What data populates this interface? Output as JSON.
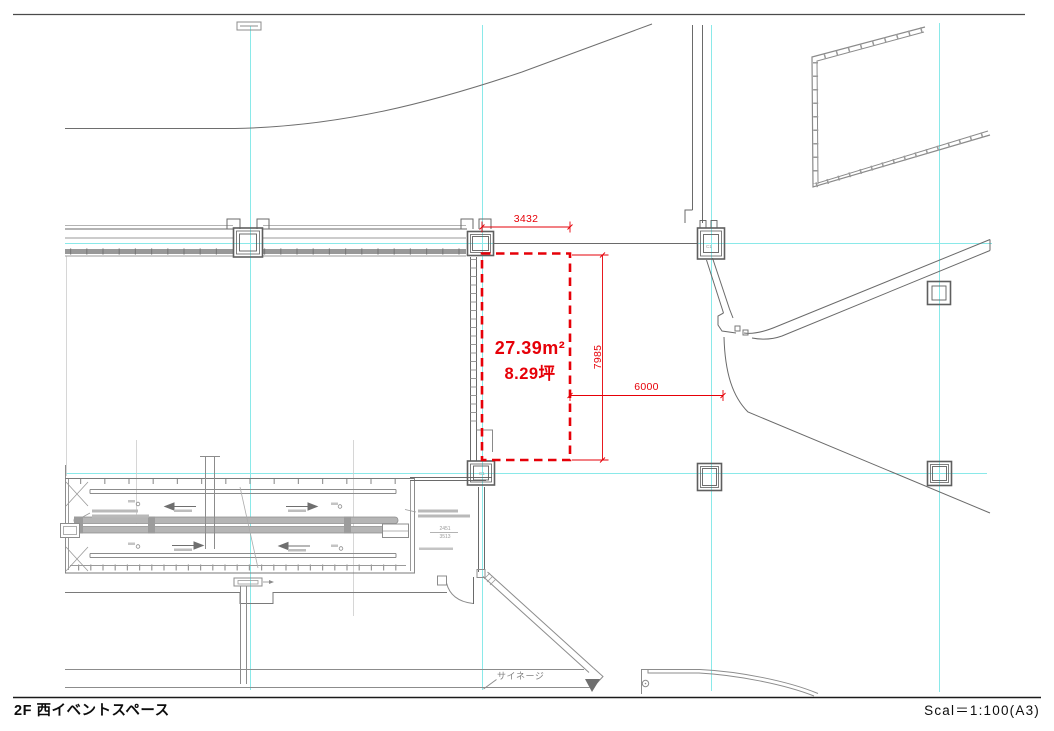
{
  "drawing": {
    "sheet": {
      "title": "2F 西イベントスペース",
      "scale_label": "Scal＝1:100(A3)"
    },
    "highlight_zone": {
      "area_m2": "27.39m²",
      "area_tsubo": "8.29坪",
      "dim_width_mm": "3432",
      "dim_height_mm": "7985",
      "dim_offset_mm": "6000"
    },
    "labels": {
      "signage": "サイネージ",
      "column": "C1",
      "mini_dim_upper": "2451",
      "mini_dim_lower": "3513"
    },
    "colors": {
      "highlight_red": "#e60008",
      "grid_cyan": "#8ae9e9",
      "line_dark": "#5f5f5f",
      "line_mid": "#8c8c8c",
      "line_light": "#b3b3b3"
    }
  }
}
